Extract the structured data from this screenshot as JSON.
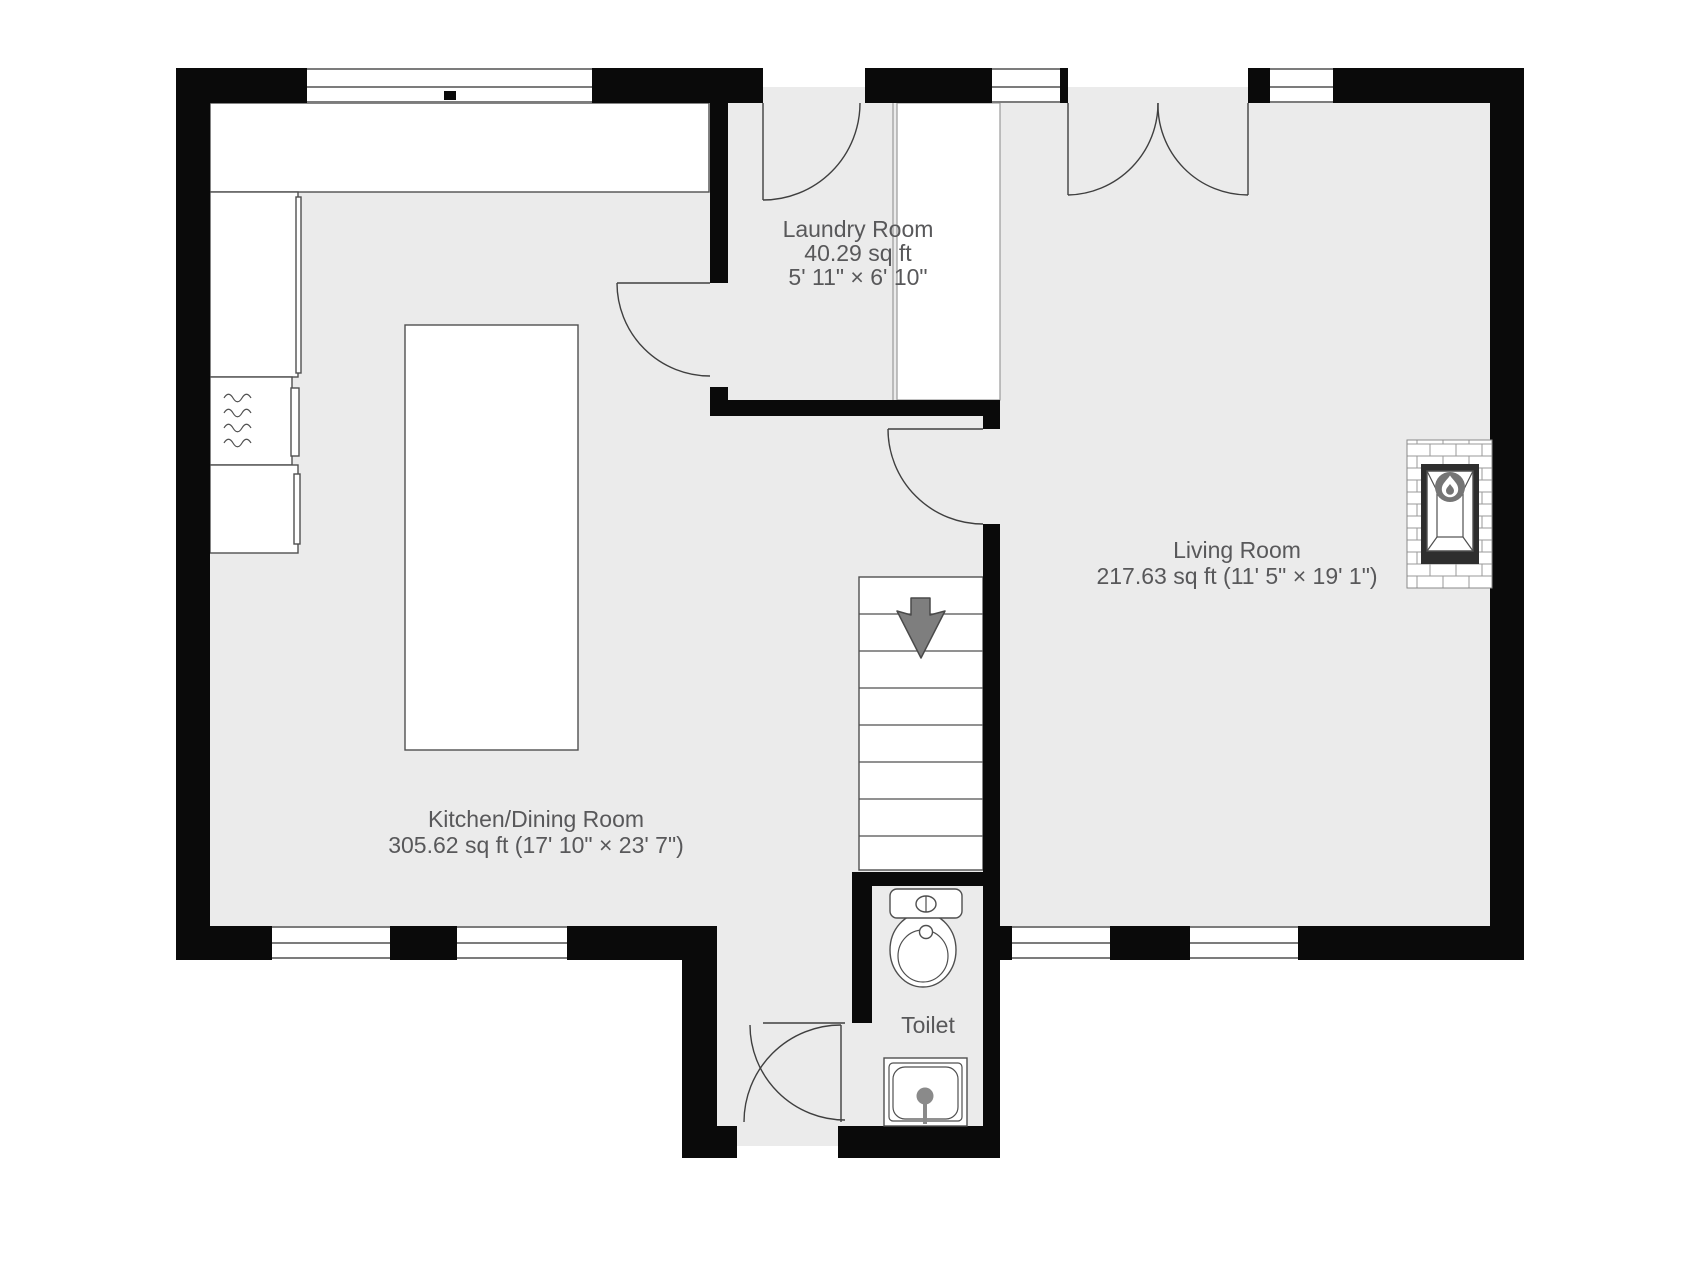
{
  "title": "Ground floor plan",
  "rooms": {
    "laundry": {
      "name": "Laundry Room",
      "area": "40.29 sq ft",
      "dims": "5' 11\" × 6' 10\""
    },
    "living": {
      "name": "Living Room",
      "area_dims": "217.63 sq ft (11' 5\" × 19' 1\")"
    },
    "kitchen": {
      "name": "Kitchen/Dining Room",
      "area_dims": "305.62 sq ft (17' 10\" × 23' 7\")"
    },
    "toilet": {
      "name": "Toilet"
    }
  },
  "icons": [
    "stairs-down-arrow-icon",
    "fireplace-flame-icon",
    "toilet-icon",
    "sink-icon",
    "microwave-icon"
  ],
  "colors": {
    "wall": "#0a0a0a",
    "floor": "#ebebeb",
    "white": "#ffffff",
    "fixture_line": "#4f4f4f",
    "soft_line": "#9a9a9a",
    "window_line": "#2f2f2f",
    "text": "#58585a",
    "arrow_fill": "#7e7e7e",
    "flame_circle": "#757575",
    "firebox_dark": "#2e2e2e"
  }
}
